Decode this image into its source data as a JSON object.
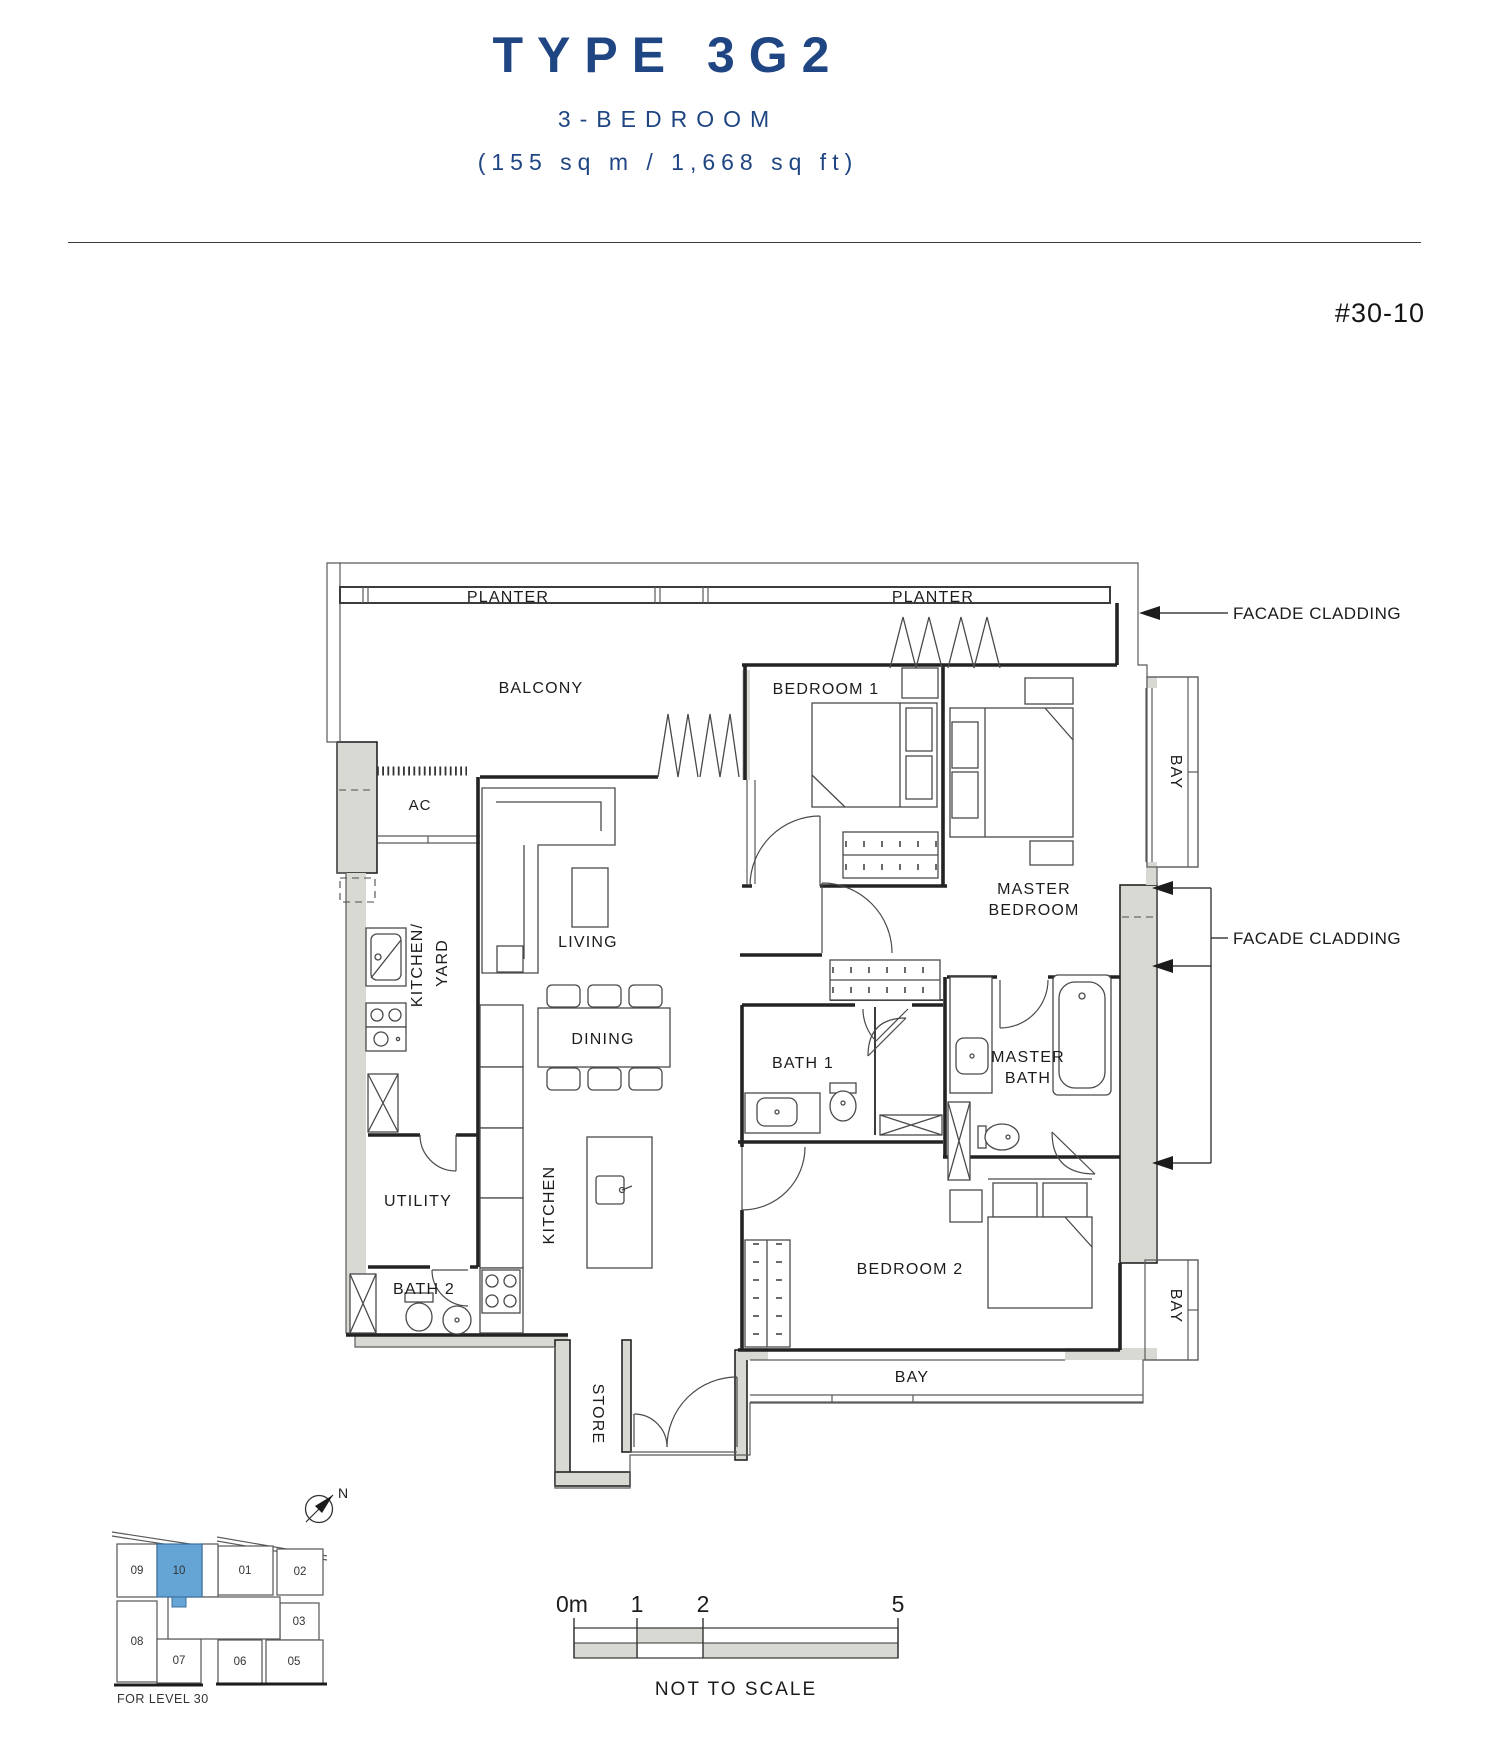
{
  "header": {
    "title": "TYPE 3G2",
    "subtitle": "3-BEDROOM",
    "area": "(155 sq m / 1,668 sq ft)",
    "unit_number": "#30-10"
  },
  "plan": {
    "labels": {
      "planter_left": "PLANTER",
      "planter_right": "PLANTER",
      "facade_cladding_top": "FACADE CLADDING",
      "facade_cladding_side": "FACADE CLADDING",
      "balcony": "BALCONY",
      "ac": "AC",
      "bedroom1": "BEDROOM 1",
      "master_bedroom_line1": "MASTER",
      "master_bedroom_line2": "BEDROOM",
      "bay_upper": "BAY",
      "bay_lower": "BAY",
      "bay_bottom": "BAY",
      "kitchen_yard_line1": "KITCHEN/",
      "kitchen_yard_line2": "YARD",
      "living": "LIVING",
      "dining": "DINING",
      "bath1": "BATH 1",
      "master_bath_line1": "MASTER",
      "master_bath_line2": "BATH",
      "utility": "UTILITY",
      "kitchen": "KITCHEN",
      "bath2": "BATH 2",
      "bedroom2": "BEDROOM 2",
      "store": "STORE"
    }
  },
  "key_plan": {
    "units": [
      "09",
      "10",
      "01",
      "02",
      "03",
      "08",
      "07",
      "06",
      "05"
    ],
    "highlighted_unit": "10",
    "caption": "FOR LEVEL 30",
    "compass": "N",
    "highlight_color": "#64a5d6"
  },
  "scale_bar": {
    "ticks": [
      "0m",
      "1",
      "2",
      "5"
    ],
    "note": "NOT TO SCALE"
  },
  "colors": {
    "accent_blue": "#1f4583",
    "wall_fill": "#d9d9d3",
    "line_dark": "#232323"
  }
}
